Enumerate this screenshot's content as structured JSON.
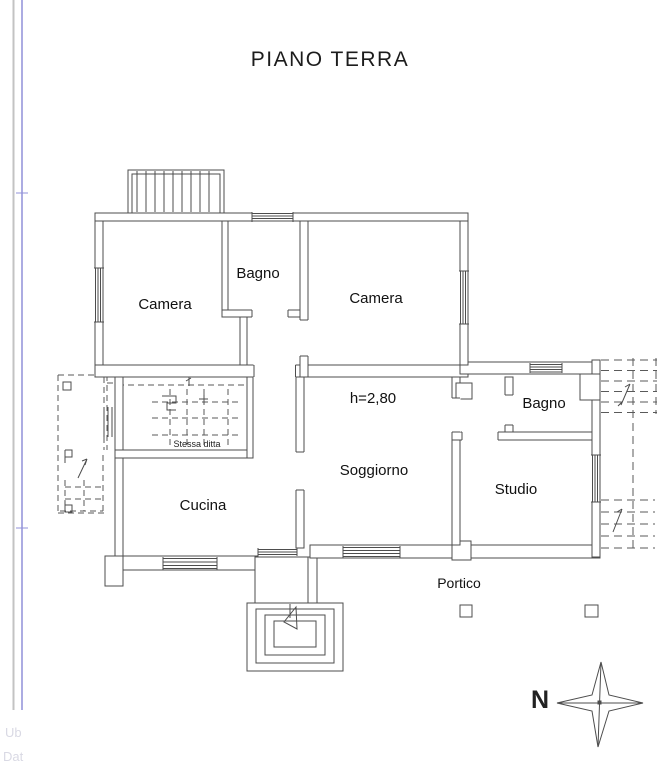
{
  "title": "PIANO TERRA",
  "rooms": {
    "camera_nw": "Camera",
    "bagno_top": "Bagno",
    "camera_ne": "Camera",
    "bagno_east": "Bagno",
    "soggiorno": "Soggiorno",
    "studio": "Studio",
    "cucina": "Cucina",
    "portico": "Portico"
  },
  "annotations": {
    "ceiling_height": "h=2,80",
    "adjacent_property_note": "Stessa ditta"
  },
  "compass": {
    "north": "N"
  },
  "margin": {
    "fragment_top": "Ub",
    "fragment_bottom": "Dat"
  },
  "colors": {
    "background": "#ffffff",
    "plan_line": "#4d4d4d",
    "label_text": "#111111",
    "ruler_gray": "#c3c3c3",
    "ruler_blue": "#9191d8",
    "faint_text": "#d9d9e4"
  }
}
